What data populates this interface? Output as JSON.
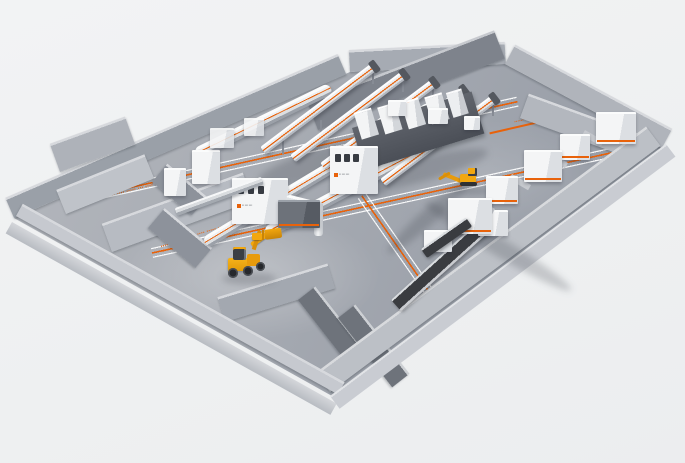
{
  "palette": {
    "accent_orange": "#e8620b",
    "floor_gray": "#a4a9b1",
    "wall_light": "#c9ccd1",
    "wall_dark": "#70757d",
    "machine_white": "#f2f3f4",
    "belt_dark": "#3a3c40",
    "vehicle_yellow": "#f2a70f",
    "background": "#eff0f1"
  },
  "floor_markings": {
    "band_1": "▪▪▪▪ ▪▪▪▪▪ ▪▪▪ ▪▪▪▪ ▪▪▪▪▪ ▪▪▪ ▪▪▪▪ ▪▪▪▪",
    "band_2": "▪▪▪▪▪ ▪▪▪ ▪▪▪▪ ▪▪▪▪▪ ▪▪▪ ▪▪▪▪ ▪▪▪▪▪ ▪▪▪ ▪▪▪▪",
    "zone_label_a_line1": "▪▪▪▪▪▪▪▪▪▪",
    "zone_label_a_line2": "▪▪▪▪",
    "zone_label_b": "▪▪▪▪▪▪▪",
    "zone_label_c": "▪▪▪▪▪▪"
  },
  "machine_badges": {
    "house_1": "▪▪ ▪▪▪ ▪▪▪",
    "house_2": "▪▪ ▪▪▪ ▪▪▪"
  }
}
